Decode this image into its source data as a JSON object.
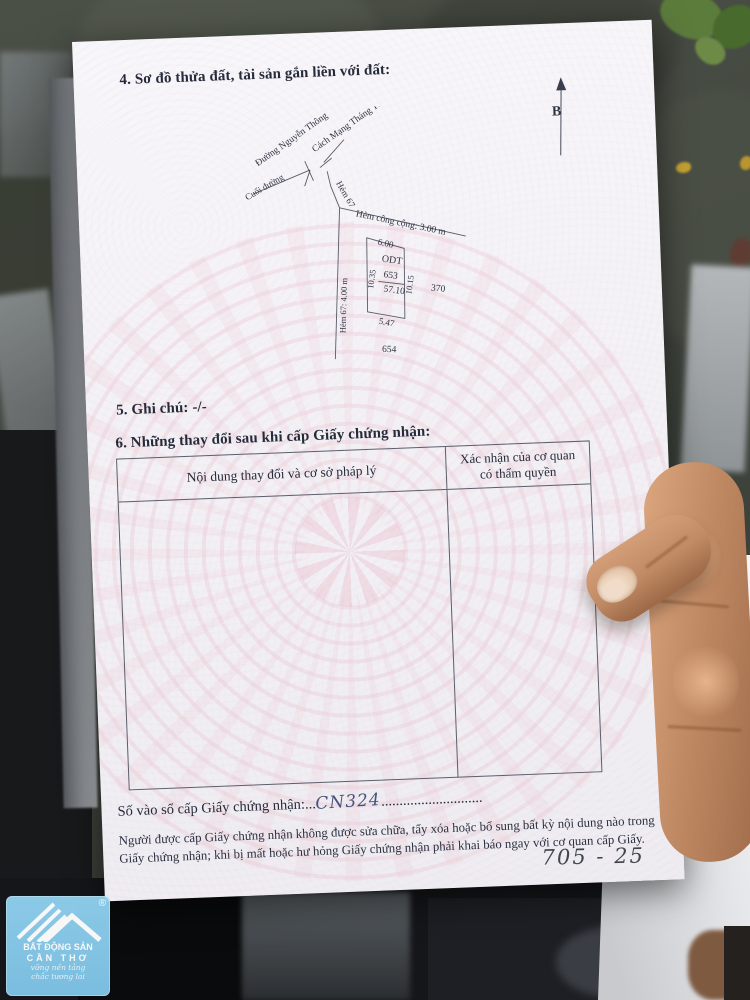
{
  "photo": {
    "handwritten_note": "705 - 25"
  },
  "certificate": {
    "section4_title": "4. Sơ đồ thửa đất, tài sản gắn liền với đất:",
    "north_arrow_label": "B",
    "diagram": {
      "street_nguyen_thong": "Đường Nguyễn Thông",
      "street_cmt8": "Cách Mạng Tháng Tám",
      "end_of_road": "Cuối đường",
      "alley67": "Hẻm 67",
      "alley67_width": "Hẻm 67: 4.00 m",
      "public_alley": "Hẻm công cộng: 3.00 m",
      "edge_top": "6.00",
      "edge_left": "10.35",
      "edge_right": "10.15",
      "edge_bottom": "5.47",
      "land_use": "ODT",
      "parcel_number": "653",
      "area": "57.10",
      "adjacent_parcel_right": "370",
      "adjacent_parcel_bottom": "654"
    },
    "section5_title": "5. Ghi chú: -/-",
    "section6_title": "6. Những thay đổi sau khi cấp Giấy chứng nhận:",
    "table": {
      "col1_header": "Nội dung thay đổi và cơ sở pháp lý",
      "col2_header": "Xác nhận của cơ quan có thẩm quyền"
    },
    "serial_label": "Số vào sổ cấp Giấy chứng nhận:",
    "serial_dots_left": "...",
    "serial_value": "CN324",
    "serial_dots_right": "............................",
    "footer_note_line1": "Người được cấp Giấy chứng nhận không được sửa chữa, tẩy xóa hoặc bổ sung bất kỳ nội dung nào trong",
    "footer_note_line2": "Giấy chứng nhận; khi bị mất hoặc hư hỏng Giấy chứng nhận phải khai báo ngay với cơ quan cấp Giấy."
  },
  "agency_logo": {
    "name_line1": "BẤT ĐỘNG SẢN",
    "name_line2": "CẦN THƠ",
    "slogan_line1": "vững nền tảng",
    "slogan_line2": "chắc tương lai",
    "registered_mark": "®"
  }
}
